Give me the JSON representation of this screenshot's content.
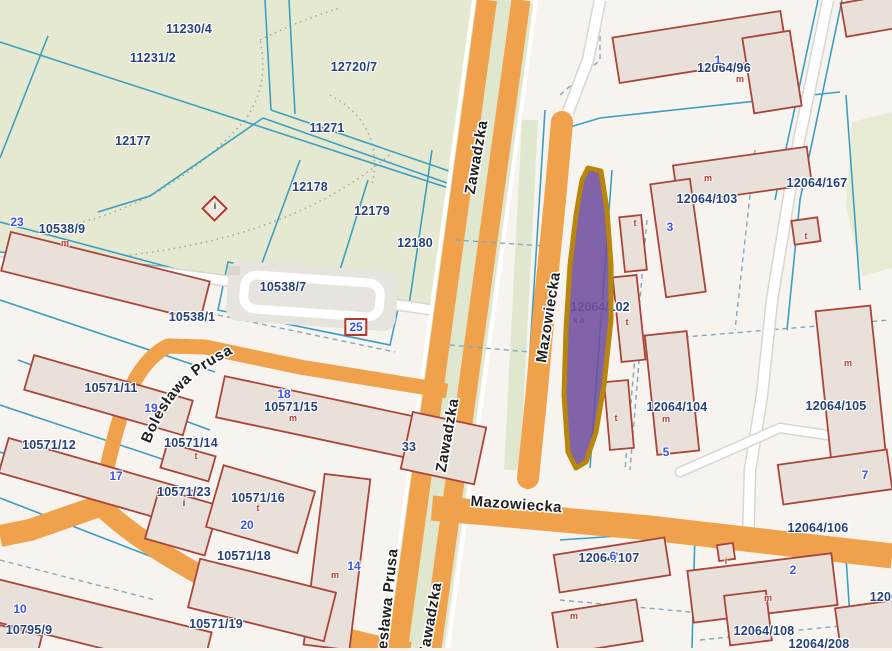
{
  "map": {
    "title": "cadastral-parcel-map",
    "colors": {
      "road_orange": "#f0a14b",
      "park_green": "#e6e9d1",
      "median_green": "#dfe8cf",
      "building_fill": "#e9e1d9",
      "building_outline": "#a9453b",
      "parcel_line_teal": "#3d9fc0",
      "parcel_label_navy": "#25427d",
      "address_blue": "#3c52e6",
      "type_label_red": "#c0392b",
      "selection_fill": "#6f4e9e",
      "selection_outline": "#b8860b"
    },
    "streets": {
      "zawadzka": "Zawadzka",
      "mazowiecka": "Mazowiecka",
      "boleslawa_prusa": "Bolesława Prusa"
    },
    "selected_parcel": {
      "label": "12064/102",
      "annotation": "k n"
    },
    "info_point": {
      "glyph": "i"
    },
    "parcel_labels": [
      {
        "text": "11230/4",
        "x": 189,
        "y": 29
      },
      {
        "text": "11231/2",
        "x": 153,
        "y": 58
      },
      {
        "text": "12720/7",
        "x": 354,
        "y": 67
      },
      {
        "text": "12177",
        "x": 133,
        "y": 141
      },
      {
        "text": "11271",
        "x": 327,
        "y": 128
      },
      {
        "text": "12178",
        "x": 310,
        "y": 187
      },
      {
        "text": "12179",
        "x": 372,
        "y": 211
      },
      {
        "text": "12180",
        "x": 415,
        "y": 243
      },
      {
        "text": "10538/9",
        "x": 62,
        "y": 229
      },
      {
        "text": "10538/7",
        "x": 283,
        "y": 287
      },
      {
        "text": "10538/1",
        "x": 192,
        "y": 317
      },
      {
        "text": "10571/11",
        "x": 111,
        "y": 388
      },
      {
        "text": "10571/12",
        "x": 49,
        "y": 445
      },
      {
        "text": "10571/14",
        "x": 191,
        "y": 443
      },
      {
        "text": "10571/15",
        "x": 291,
        "y": 407
      },
      {
        "text": "10571/23",
        "x": 184,
        "y": 492
      },
      {
        "text": "10571/16",
        "x": 258,
        "y": 498
      },
      {
        "text": "10571/18",
        "x": 244,
        "y": 556
      },
      {
        "text": "10571/19",
        "x": 216,
        "y": 624
      },
      {
        "text": "10795/9",
        "x": 29,
        "y": 630
      },
      {
        "text": "33",
        "x": 409,
        "y": 447
      },
      {
        "text": "12064/96",
        "x": 724,
        "y": 68
      },
      {
        "text": "12064/103",
        "x": 707,
        "y": 199
      },
      {
        "text": "12064/167",
        "x": 817,
        "y": 183
      },
      {
        "text": "12064/104",
        "x": 677,
        "y": 407
      },
      {
        "text": "12064/105",
        "x": 836,
        "y": 406
      },
      {
        "text": "12064/106",
        "x": 818,
        "y": 528
      },
      {
        "text": "12064/107",
        "x": 609,
        "y": 558
      },
      {
        "text": "12064/108",
        "x": 764,
        "y": 631
      },
      {
        "text": "12064/208",
        "x": 819,
        "y": 644
      },
      {
        "text": "1206",
        "x": 884,
        "y": 597
      }
    ],
    "address_markers": [
      {
        "text": "23",
        "x": 17,
        "y": 222
      },
      {
        "text": "25",
        "x": 356,
        "y": 327,
        "variant": "boxed"
      },
      {
        "text": "19",
        "x": 151,
        "y": 408
      },
      {
        "text": "17",
        "x": 116,
        "y": 476
      },
      {
        "text": "18",
        "x": 284,
        "y": 394
      },
      {
        "text": "20",
        "x": 247,
        "y": 525
      },
      {
        "text": "14",
        "x": 354,
        "y": 566
      },
      {
        "text": "10",
        "x": 20,
        "y": 609
      },
      {
        "text": "1",
        "x": 718,
        "y": 60
      },
      {
        "text": "3",
        "x": 670,
        "y": 227
      },
      {
        "text": "5",
        "x": 666,
        "y": 452
      },
      {
        "text": "7",
        "x": 865,
        "y": 475
      },
      {
        "text": "2",
        "x": 793,
        "y": 570
      },
      {
        "text": "6",
        "x": 613,
        "y": 556
      }
    ],
    "building_labels": [
      {
        "text": "m",
        "x": 65,
        "y": 243,
        "color": "#c0392b"
      },
      {
        "text": "m",
        "x": 293,
        "y": 418,
        "color": "#c0392b"
      },
      {
        "text": "m",
        "x": 335,
        "y": 575,
        "color": "#c0392b"
      },
      {
        "text": "m",
        "x": 740,
        "y": 79,
        "color": "#c0392b"
      },
      {
        "text": "m",
        "x": 708,
        "y": 178,
        "color": "#c0392b"
      },
      {
        "text": "m",
        "x": 666,
        "y": 419,
        "color": "#c0392b"
      },
      {
        "text": "m",
        "x": 848,
        "y": 363,
        "color": "#c0392b"
      },
      {
        "text": "m",
        "x": 768,
        "y": 598,
        "color": "#c0392b"
      },
      {
        "text": "m",
        "x": 574,
        "y": 616,
        "color": "#c0392b"
      },
      {
        "text": "t",
        "x": 258,
        "y": 508,
        "color": "#c0392b"
      },
      {
        "text": "t",
        "x": 635,
        "y": 223,
        "color": "#c0392b"
      },
      {
        "text": "t",
        "x": 627,
        "y": 322,
        "color": "#c0392b"
      },
      {
        "text": "t",
        "x": 616,
        "y": 418,
        "color": "#c0392b"
      },
      {
        "text": "t",
        "x": 806,
        "y": 236,
        "color": "#c0392b"
      },
      {
        "text": "t",
        "x": 196,
        "y": 456,
        "color": "#c0392b"
      },
      {
        "text": "i",
        "x": 184,
        "y": 503,
        "color": "#3b3b3b"
      },
      {
        "text": "i",
        "x": 726,
        "y": 561,
        "color": "#c0392b"
      }
    ]
  }
}
